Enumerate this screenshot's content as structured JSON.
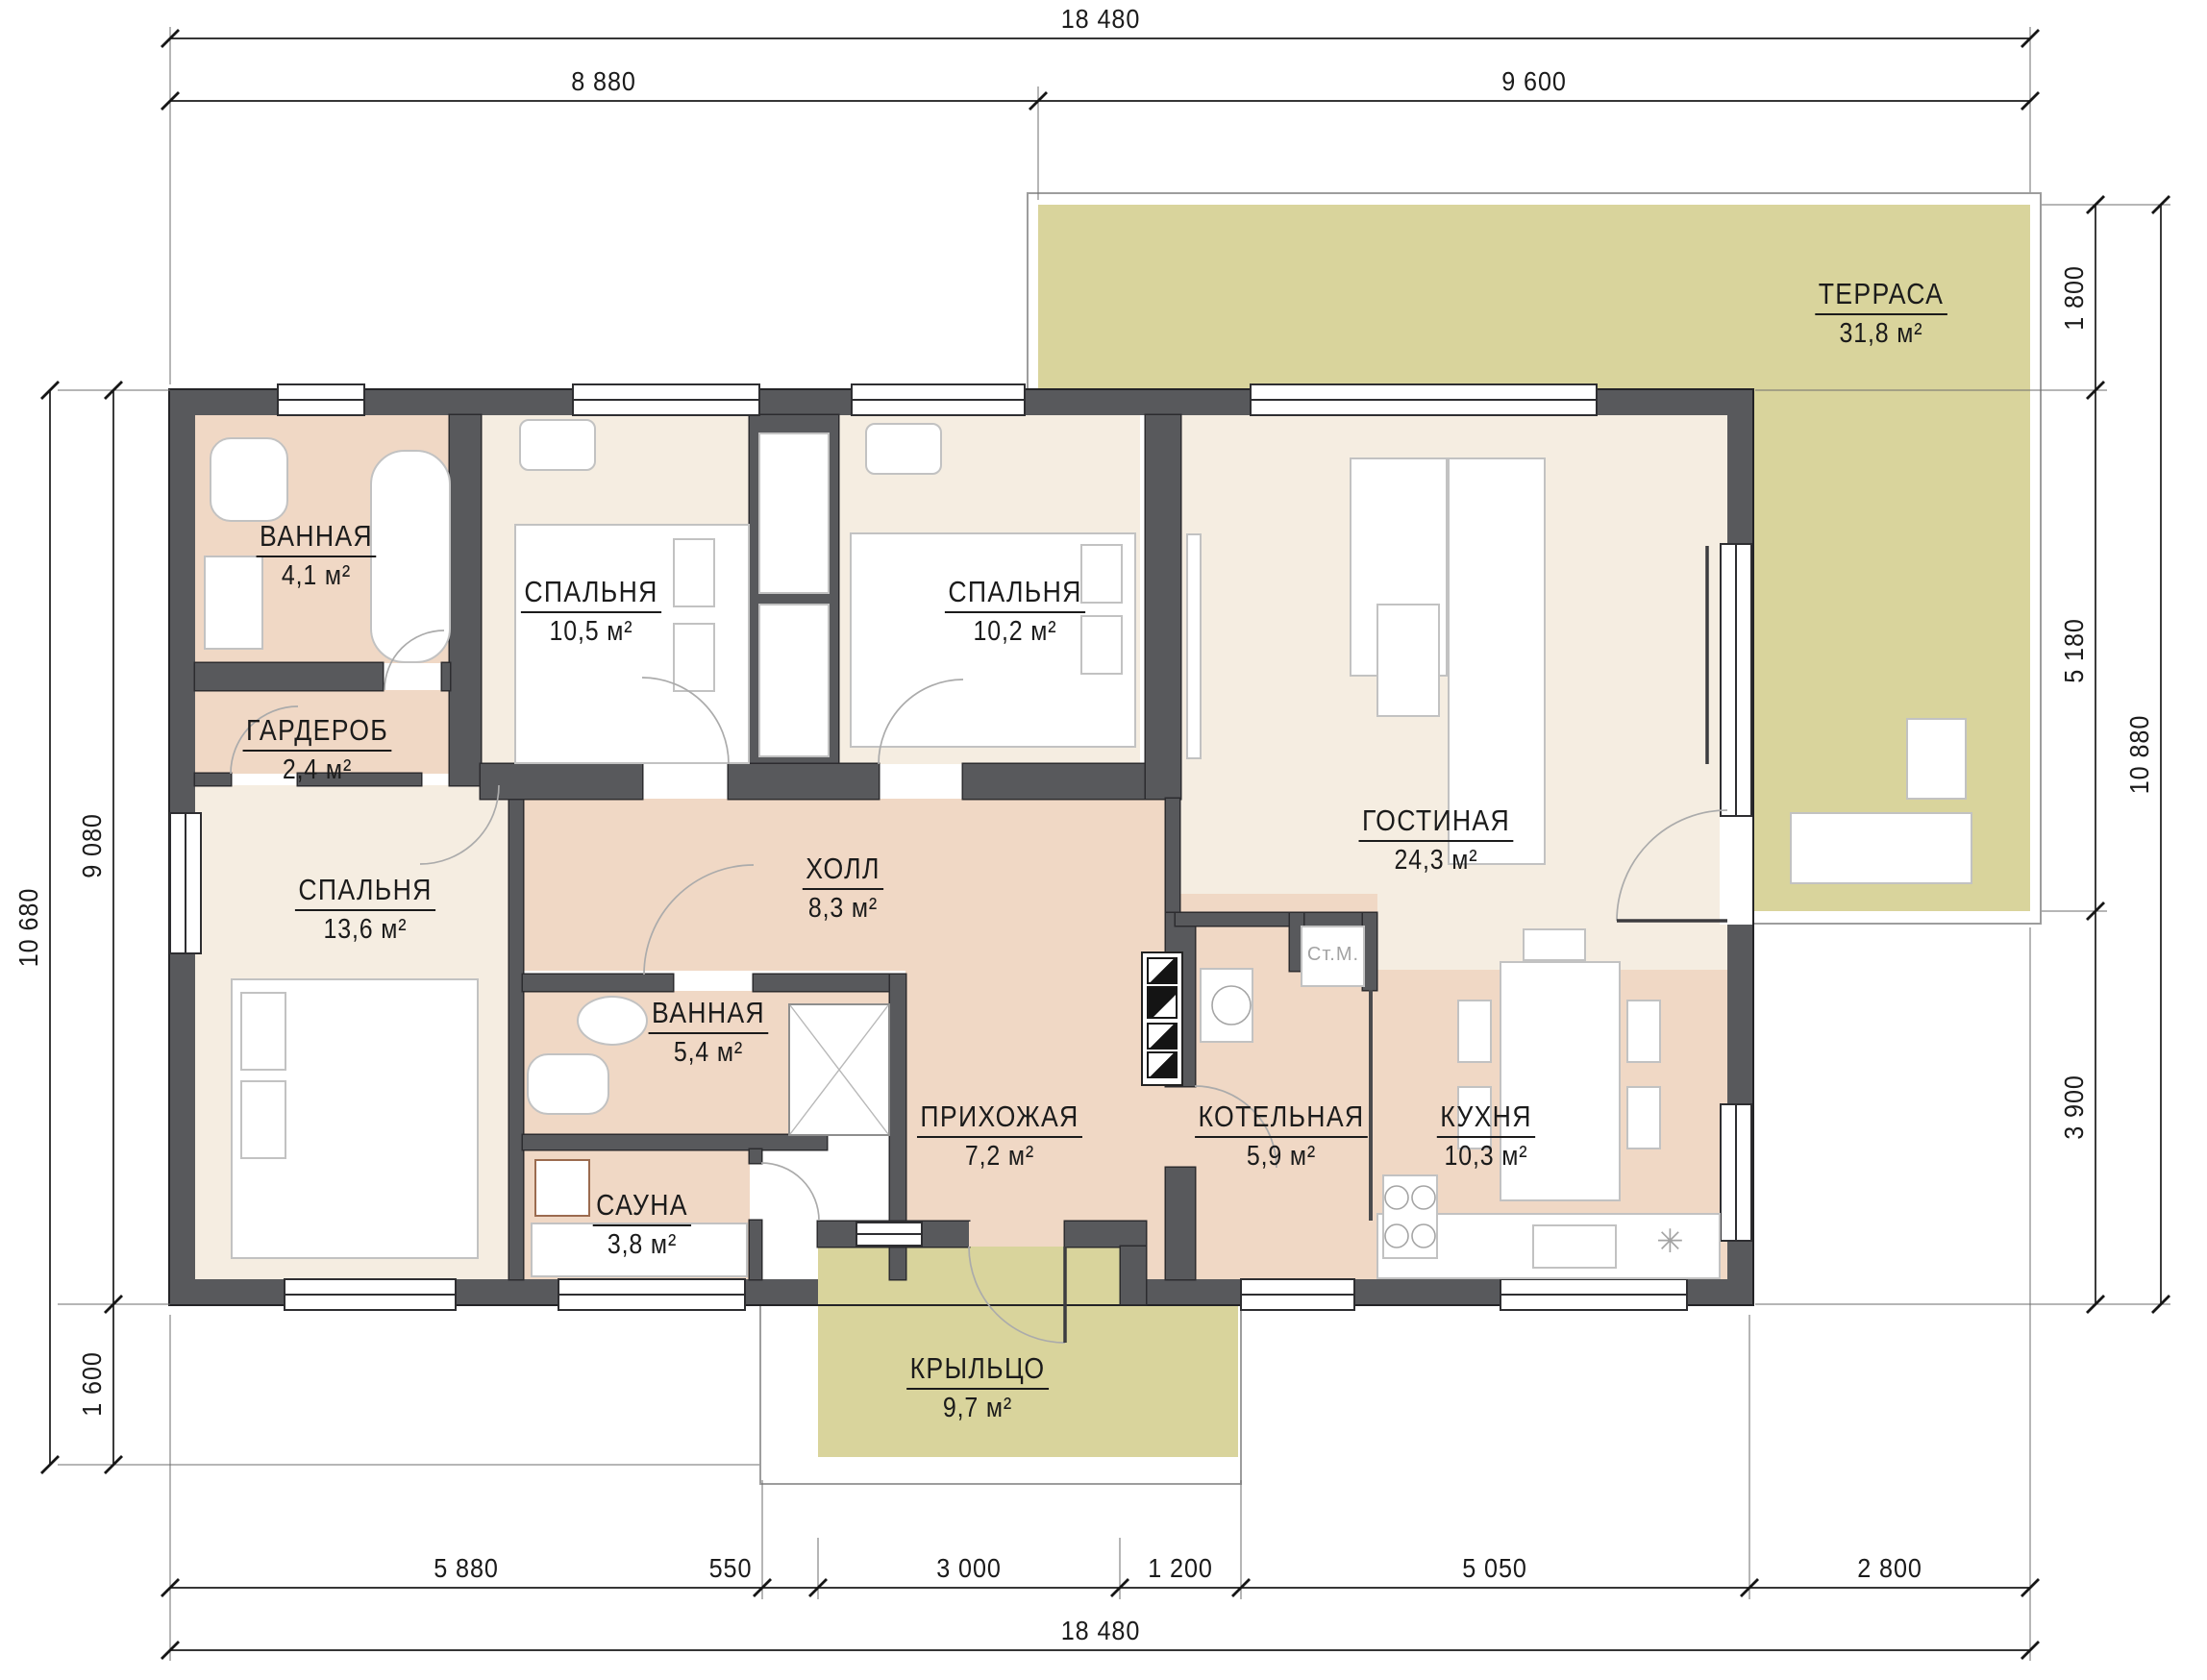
{
  "title": "План одноэтажного дома 18480 × 10880",
  "colors": {
    "wall": "#58595c",
    "cream": "#f5ede1",
    "warm": "#f0d8c5",
    "outdoor": "#d9d49c",
    "line": "#1b1b1b"
  },
  "rooms": {
    "terrace": {
      "name": "ТЕРРАСА",
      "area": "31,8 м²"
    },
    "bathroom_top": {
      "name": "ВАННАЯ",
      "area": "4,1 м²"
    },
    "bedroom_1": {
      "name": "СПАЛЬНЯ",
      "area": "10,5 м²"
    },
    "bedroom_2": {
      "name": "СПАЛЬНЯ",
      "area": "10,2 м²"
    },
    "living": {
      "name": "ГОСТИНАЯ",
      "area": "24,3 м²"
    },
    "wardrobe": {
      "name": "ГАРДЕРОБ",
      "area": "2,4 м²"
    },
    "bedroom_3": {
      "name": "СПАЛЬНЯ",
      "area": "13,6 м²"
    },
    "hall": {
      "name": "ХОЛЛ",
      "area": "8,3 м²"
    },
    "bathroom_mid": {
      "name": "ВАННАЯ",
      "area": "5,4 м²"
    },
    "sauna": {
      "name": "САУНА",
      "area": "3,8 м²"
    },
    "entry": {
      "name": "ПРИХОЖАЯ",
      "area": "7,2 м²"
    },
    "boiler": {
      "name": "КОТЕЛЬНАЯ",
      "area": "5,9 м²"
    },
    "kitchen": {
      "name": "КУХНЯ",
      "area": "10,3 м²"
    },
    "porch": {
      "name": "КРЫЛЬЦО",
      "area": "9,7 м²"
    }
  },
  "dims": {
    "top_total": "18 480",
    "top_segments": [
      "8 880",
      "9 600"
    ],
    "bottom_segments": [
      "5 880",
      "550",
      "3 000",
      "1 200",
      "5 050",
      "2 800"
    ],
    "bottom_total": "18 480",
    "left_segments": [
      "9 080",
      "1 600"
    ],
    "left_total": "10 680",
    "right_segments": [
      "1 800",
      "5 180",
      "3 900"
    ],
    "right_total": "10 880"
  },
  "labels": {
    "washing_machine": "Ст.М.",
    "snowflake": "✳"
  }
}
